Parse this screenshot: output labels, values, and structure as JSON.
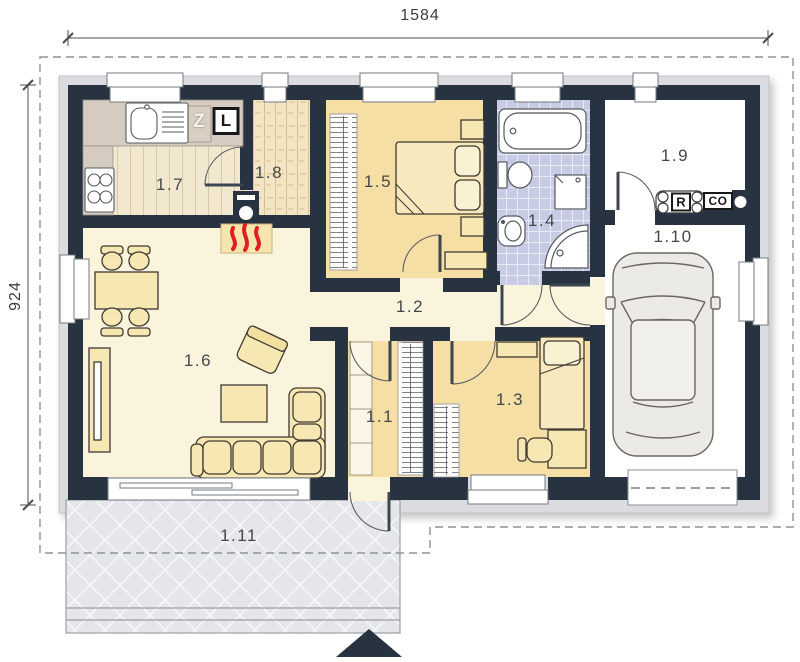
{
  "title": "House floor plan",
  "dimensions": {
    "top": "1584",
    "left": "924"
  },
  "rooms": {
    "r1_1": {
      "label": "1.1"
    },
    "r1_2": {
      "label": "1.2"
    },
    "r1_3": {
      "label": "1.3"
    },
    "r1_4": {
      "label": "1.4"
    },
    "r1_5": {
      "label": "1.5"
    },
    "r1_6": {
      "label": "1.6"
    },
    "r1_7": {
      "label": "1.7"
    },
    "r1_8": {
      "label": "1.8"
    },
    "r1_9": {
      "label": "1.9"
    },
    "r1_10": {
      "label": "1.10"
    },
    "r1_11": {
      "label": "1.11"
    }
  },
  "equipment": {
    "z_label": "Z",
    "l_label": "L",
    "r_label": "R",
    "co_label": "CO"
  },
  "colors": {
    "wall": "#273340",
    "floor_cream": "#fbf4dc",
    "floor_tan": "#f6dfa4",
    "floor_tile": "#c7cbe4",
    "floor_wood": "#f1e8cf",
    "counter": "#d6cbc0",
    "terrace": "#e4e6e9",
    "flame_red": "#e02020"
  }
}
